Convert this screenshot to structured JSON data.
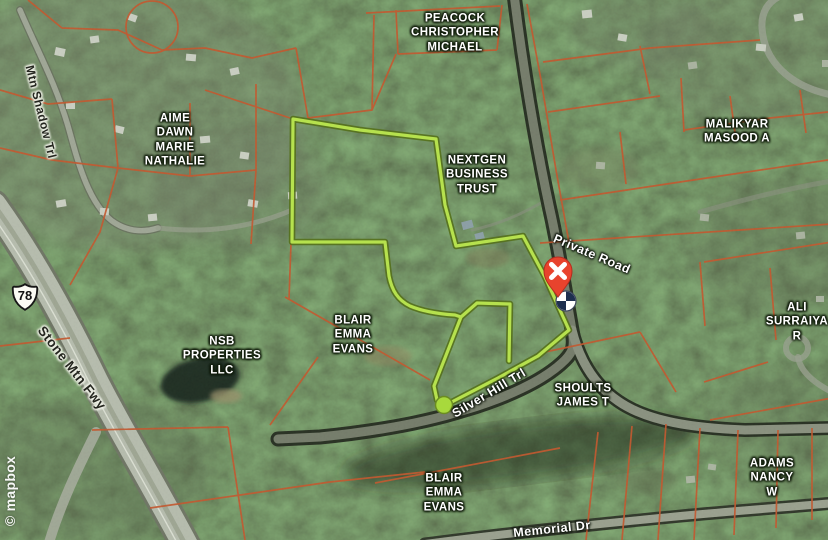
{
  "map": {
    "attribution": "© mapbox",
    "highway_shield": {
      "route": "78"
    },
    "parcel_labels": {
      "peacock": [
        "PEACOCK",
        "CHRISTOPHER",
        "MICHAEL"
      ],
      "aime": [
        "AIME",
        "DAWN",
        "MARIE",
        "NATHALIE"
      ],
      "malikyar": [
        "MALIKYAR",
        "MASOOD A"
      ],
      "nextgen": [
        "NEXTGEN",
        "BUSINESS",
        "TRUST"
      ],
      "ali": [
        "ALI",
        "SURRAIYA",
        "R"
      ],
      "nsb": [
        "NSB",
        "PROPERTIES",
        "LLC"
      ],
      "blair_upper": [
        "BLAIR",
        "EMMA",
        "EVANS"
      ],
      "shoults": [
        "SHOULTS",
        "JAMES T"
      ],
      "blair_lower": [
        "BLAIR",
        "EMMA",
        "EVANS"
      ],
      "adams": [
        "ADAMS",
        "NANCY",
        "W"
      ]
    },
    "road_labels": {
      "mtn_shadow": "Mtn Shadow Trl",
      "stone_mtn_fwy": "Stone Mtn Fwy",
      "private_road": "Private Road",
      "silver_hill": "Silver Hill Trl",
      "memorial_dr": "Memorial Dr"
    },
    "markers": {
      "destination": "red pin with X",
      "survey_point": "quartered circle",
      "route_start": "green dot"
    },
    "colors": {
      "parcel_line": "#c6552c",
      "highlight_outline": "#b6e14e",
      "marker_red": "#e8432d",
      "forest_base": "#2e3b27"
    }
  }
}
